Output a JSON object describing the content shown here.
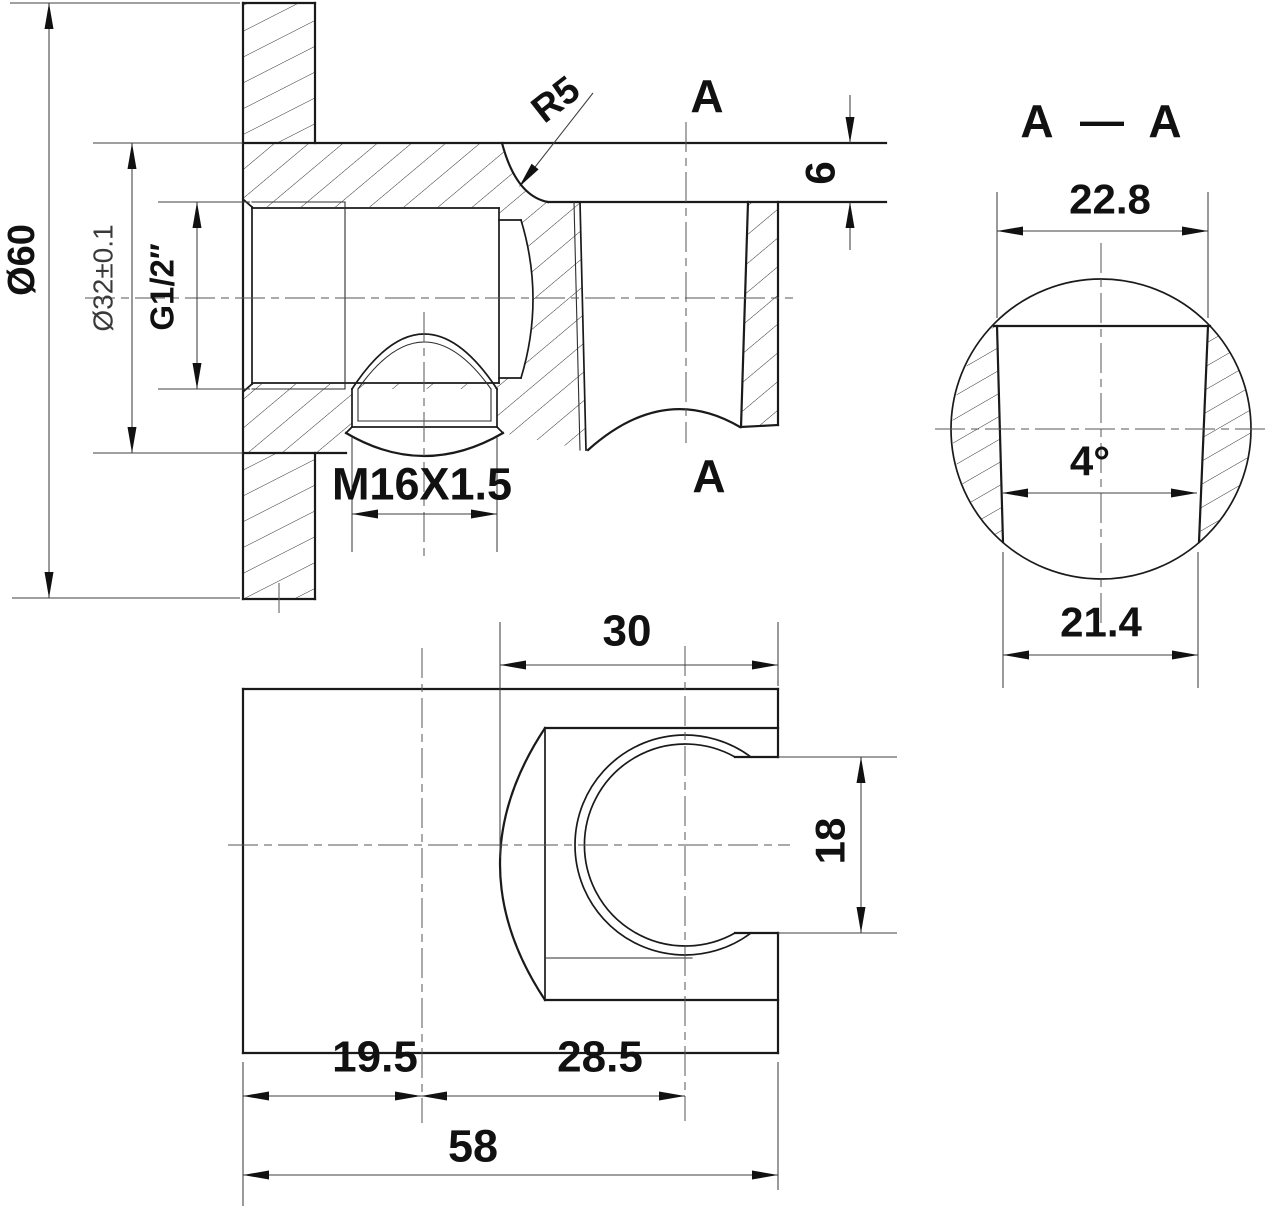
{
  "drawing": {
    "type": "mechanical-cad-drawing",
    "views": {
      "main_section": "wall elbow cross-section",
      "section_aa": "A-A cup section",
      "side_view": "holder side view"
    },
    "section_marks": {
      "letter": "A",
      "dash": "—"
    },
    "dimensions": {
      "flange_diameter": "Ø60",
      "body_diameter": "Ø32±0.1",
      "thread_inlet": "G1/2″",
      "thread_bottom": "M16X1.5",
      "fillet_radius": "R5",
      "arm_wall_thickness": "6",
      "cup_top_width": "22.8",
      "draft_angle": "4°",
      "cup_bottom_width": "21.4",
      "cup_outer_width": "30",
      "notch_height": "18",
      "offset_left": "19.5",
      "offset_right": "28.5",
      "total_width": "58"
    },
    "colors": {
      "object_line": "#1a1a1a",
      "thin_line": "#3f3f3f",
      "centerline": "#555555",
      "background": "#ffffff"
    }
  }
}
